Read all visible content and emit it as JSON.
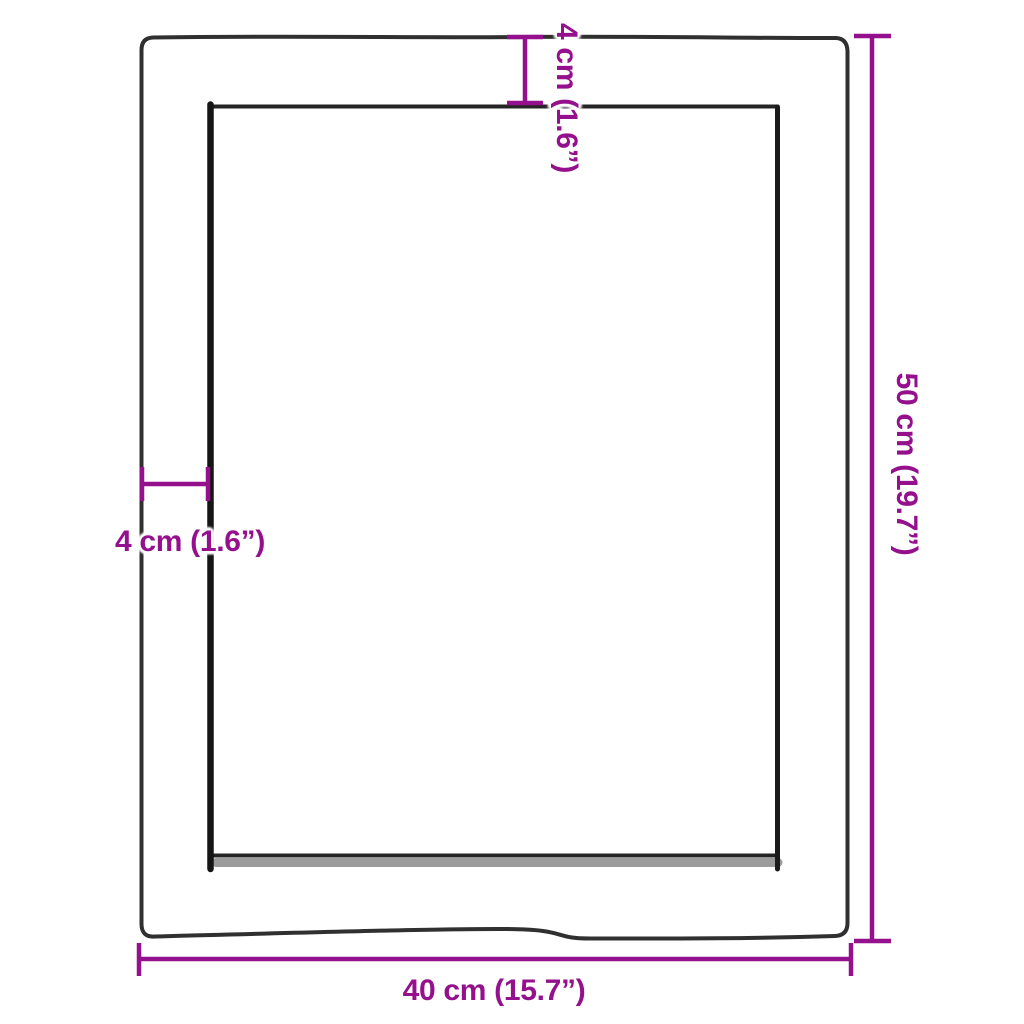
{
  "colors": {
    "dimension": "#94108C",
    "outline": "#303030",
    "outline_strong": "#161616",
    "shadow_gray": "#9B9B9B",
    "background": "#FFFFFF"
  },
  "labels": {
    "width": "40 cm (15.7”)",
    "height": "50 cm (19.7”)",
    "thickness_top": "4 cm (1.6”)",
    "thickness_side": "4 cm (1.6”)"
  }
}
